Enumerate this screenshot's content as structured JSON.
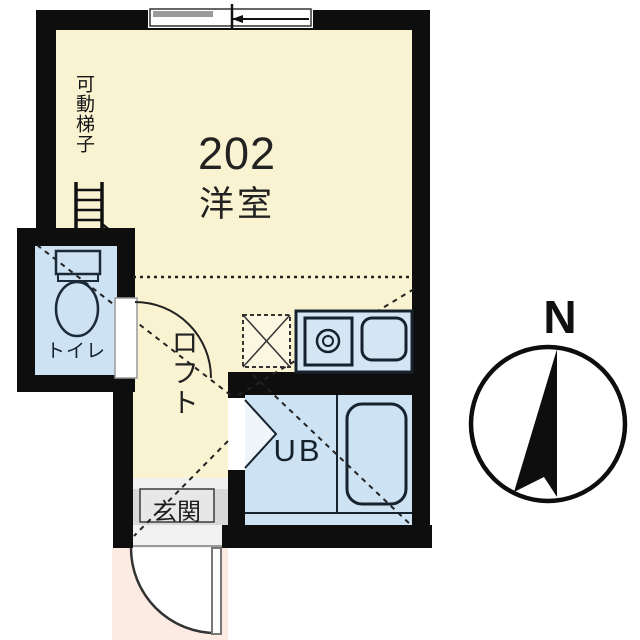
{
  "floorplan": {
    "labels": {
      "movable_ladder": "可動梯子",
      "unit_number": "202",
      "room_type": "洋室",
      "toilet": "トイレ",
      "loft": "ロフト",
      "unit_bath": "UB",
      "entrance": "玄関",
      "compass_north": "N"
    },
    "colors": {
      "wall": "#0e0e0e",
      "room_fill": "#faf3d2",
      "wet_area_fill": "#cde2f2",
      "kitchen_fill": "#d4e6f4",
      "entrance_fill": "#d8d8d8",
      "outside_entrance_fill": "#fcebe2",
      "fixture_stroke": "#1a2a38"
    }
  }
}
